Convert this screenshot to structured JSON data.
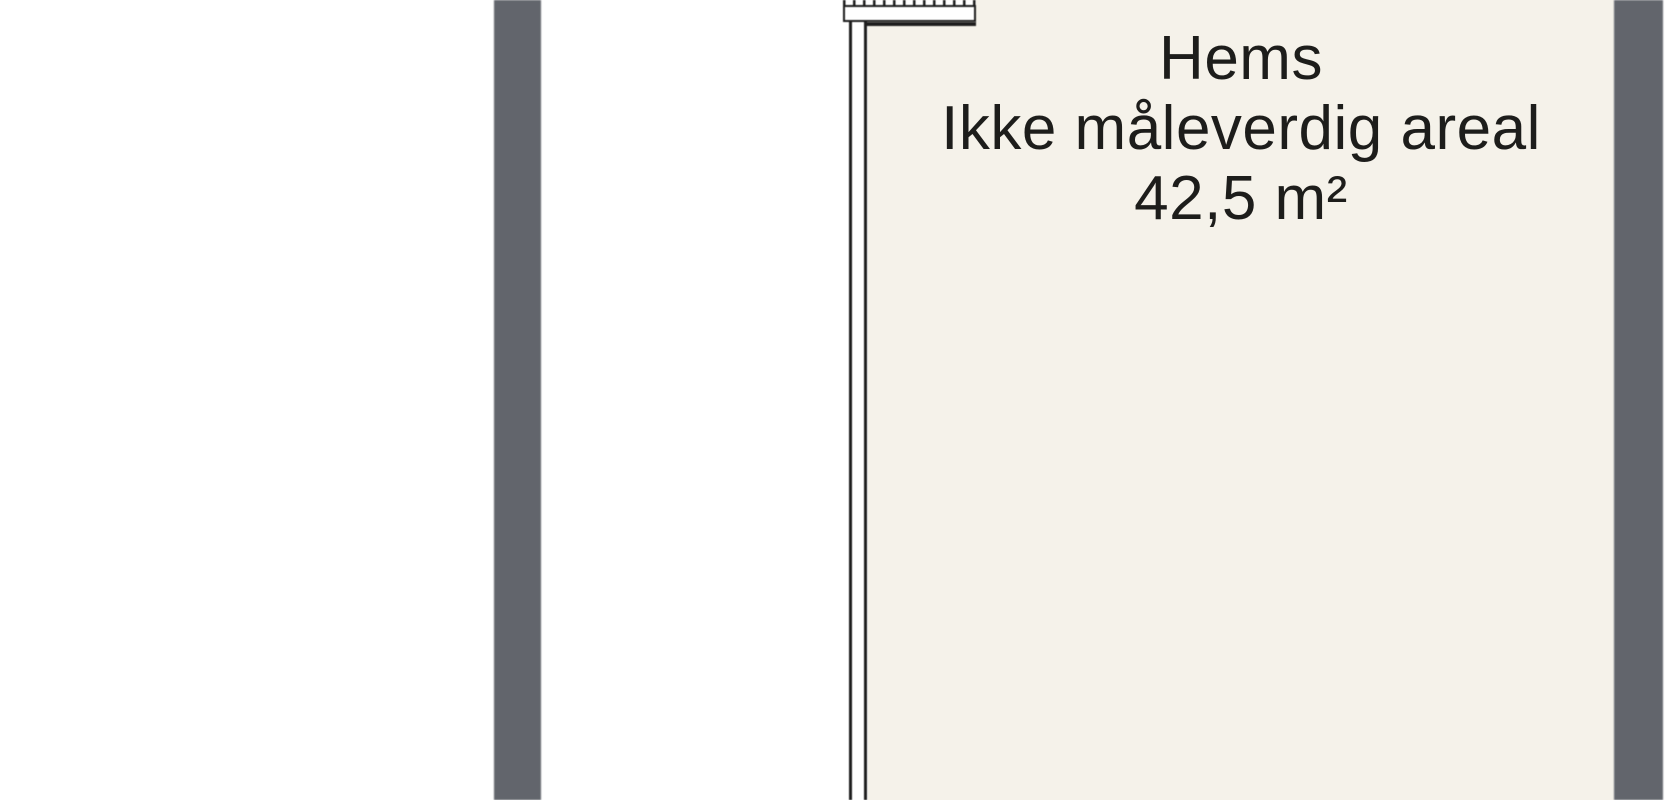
{
  "plan": {
    "room": {
      "title": "Hems",
      "subtitle": "Ikke måleverdig areal",
      "area": "42,5 m²"
    },
    "colors": {
      "page_background": "#ffffff",
      "floor": "#f5f2ea",
      "wall_band": "#62656c",
      "line": "#1e1e1e",
      "text": "#1d1d1b"
    }
  }
}
